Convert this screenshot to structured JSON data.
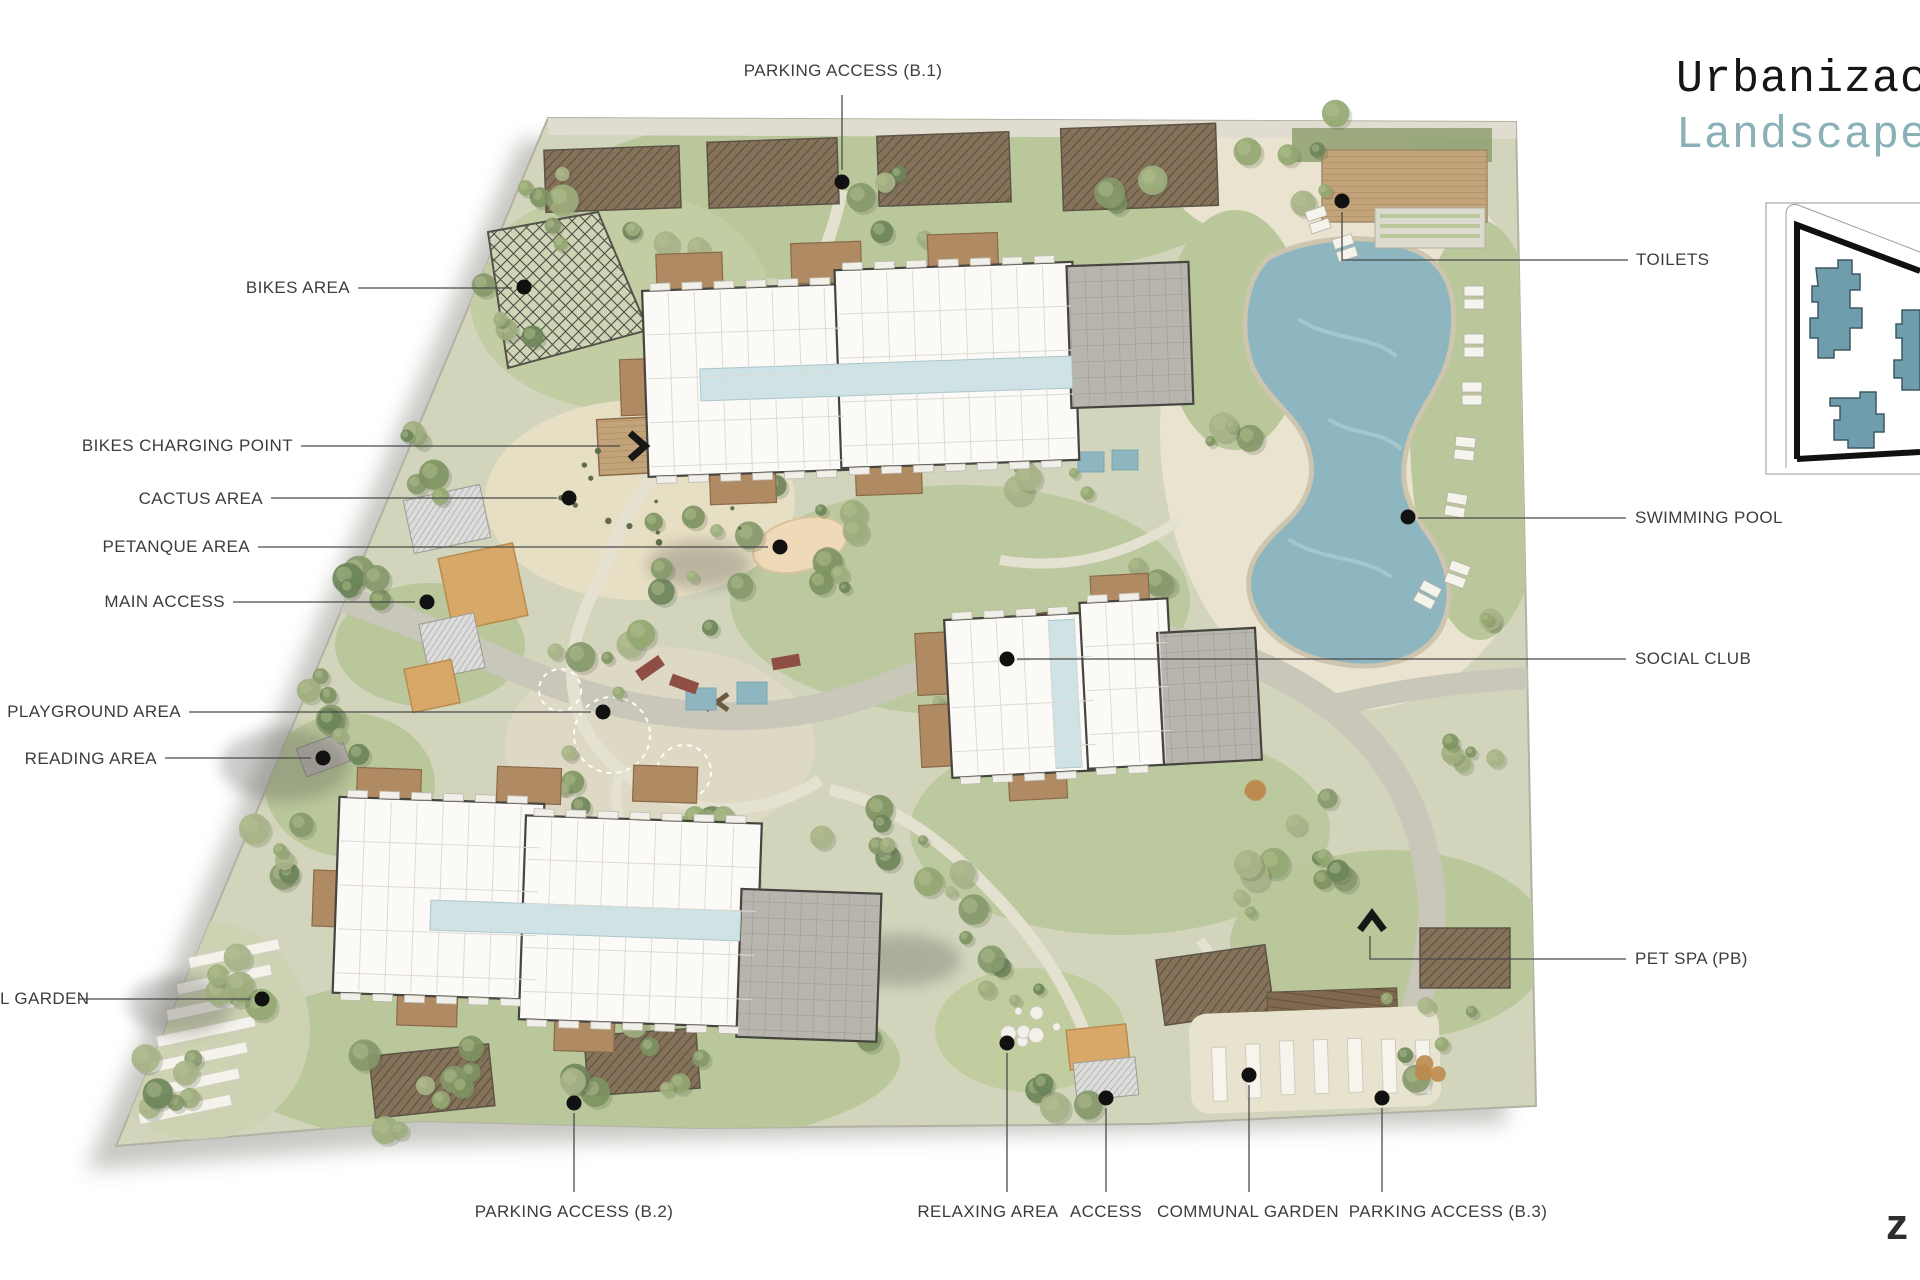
{
  "document": {
    "title": "Urbanizac",
    "subtitle": "Landscape",
    "watermark": "z"
  },
  "colors": {
    "label_text": "#3D3D3D",
    "leader_line": "#4A4A4A",
    "title": "#161616",
    "subtitle": "#8AB0B8",
    "pool_water": "#8DB6C0",
    "keymap_building": "#6F9DAB",
    "marker_dot": "#111111",
    "lawn_green": "#B9C79A",
    "canopy_orange": "#D8A868",
    "wood_deck": "#B08A63"
  },
  "callouts": {
    "parking_b1": "PARKING ACCESS (B.1)",
    "bikes_area": "BIKES AREA",
    "bikes_charging": "BIKES CHARGING POINT",
    "cactus": "CACTUS AREA",
    "petanque": "PETANQUE AREA",
    "main_access": "MAIN ACCESS",
    "playground": "PLAYGROUND AREA",
    "reading": "READING AREA",
    "garden_left_clipped": "L GARDEN",
    "toilets": "TOILETS",
    "swimming_pool": "SWIMMING POOL",
    "social_club": "SOCIAL CLUB",
    "pet_spa": "PET SPA (PB)",
    "parking_b2": "PARKING ACCESS (B.2)",
    "relaxing": "RELAXING AREA",
    "access": "ACCESS",
    "communal_garden": "COMMUNAL GARDEN",
    "parking_b3": "PARKING ACCESS (B.3)"
  }
}
